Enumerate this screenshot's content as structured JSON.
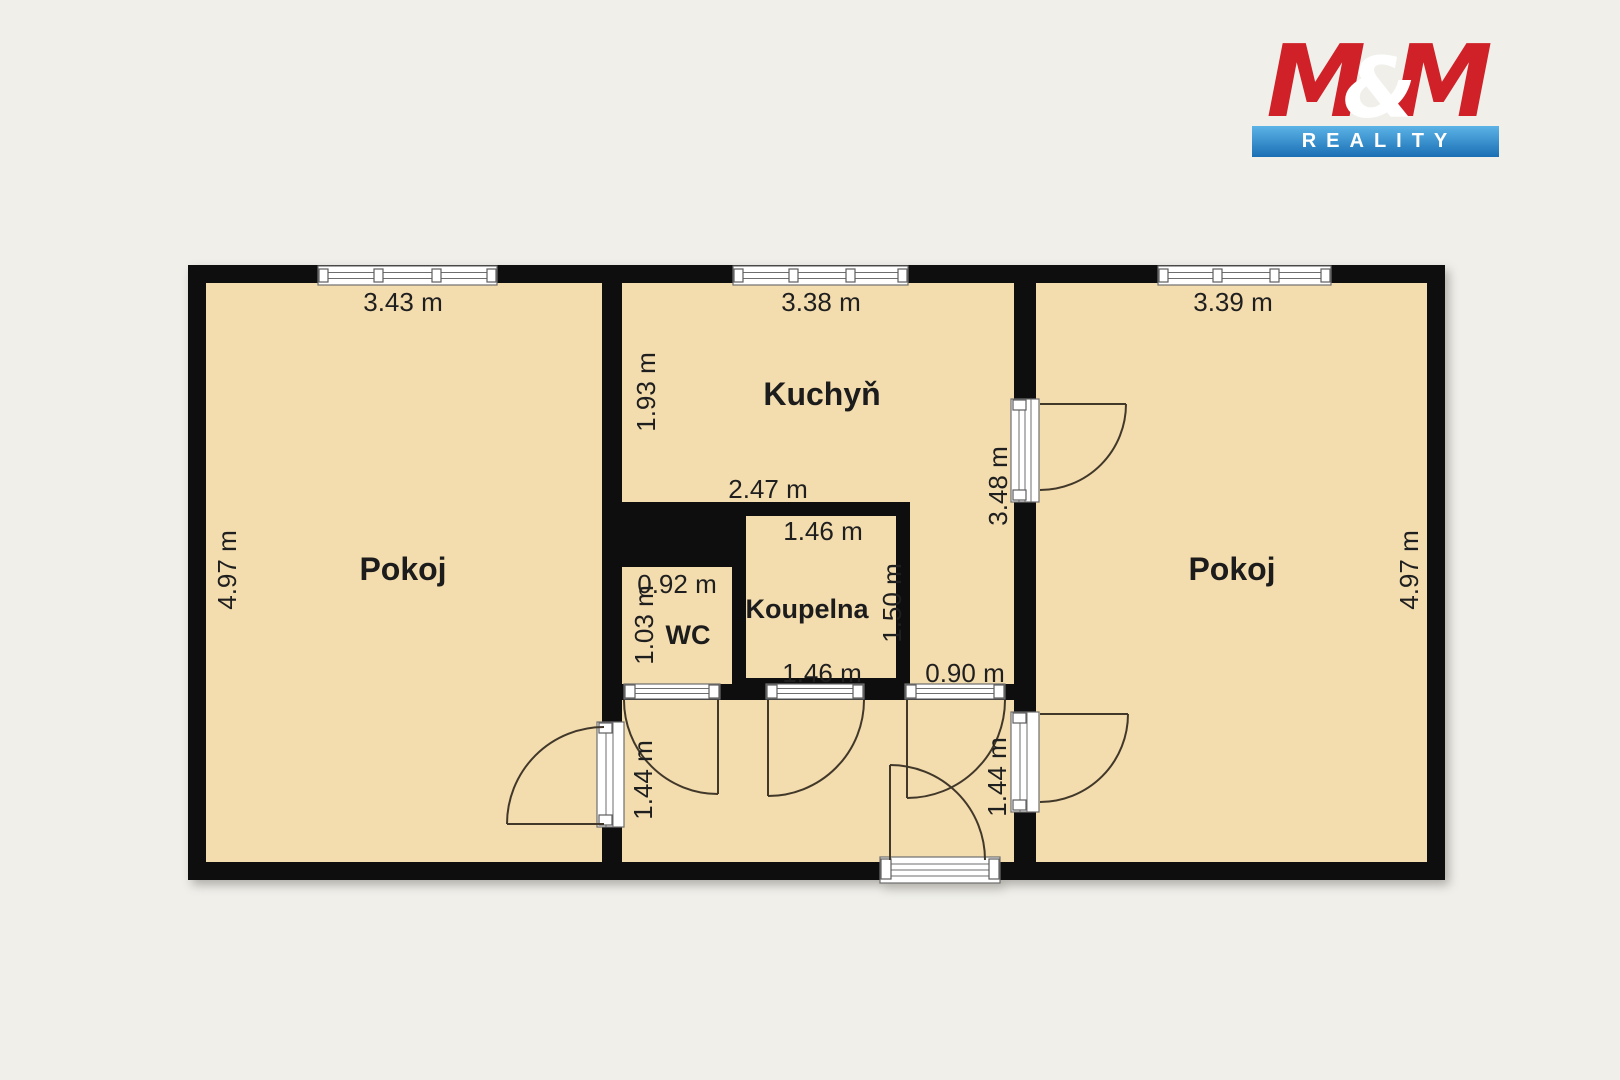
{
  "logo": {
    "m1": "M",
    "amp": "&",
    "m2": "M",
    "subtitle": "REALITY",
    "red": "#cf2127",
    "blue_top": "#5cb3e6",
    "blue_bottom": "#1a6fb4"
  },
  "plan": {
    "rooms": {
      "pokoj_left": "Pokoj",
      "kuchyn": "Kuchyň",
      "koupelna": "Koupelna",
      "wc": "WC",
      "pokoj_right": "Pokoj"
    },
    "dims": {
      "top_left": "3.43 m",
      "top_mid": "3.38 m",
      "top_right": "3.39 m",
      "side_left": "4.97 m",
      "side_right": "4.97 m",
      "kitchen_left": "1.93 m",
      "kitchen_right": "3.48 m",
      "kitchen_bottom": "2.47 m",
      "bath_top": "1.46 m",
      "bath_bottom": "1.46 m",
      "bath_right": "1.50 m",
      "wc_top": "0.92 m",
      "wc_left": "1.03 m",
      "hall_left": "1.44 m",
      "hall_right": "1.44 m",
      "hall_opening": "0.90 m"
    }
  },
  "colors": {
    "background": "#f0efea",
    "floor": "#f3dcae",
    "wall": "#0e0e0e",
    "dimension_text": "#1f1f1f",
    "door_arc": "#41382a"
  }
}
